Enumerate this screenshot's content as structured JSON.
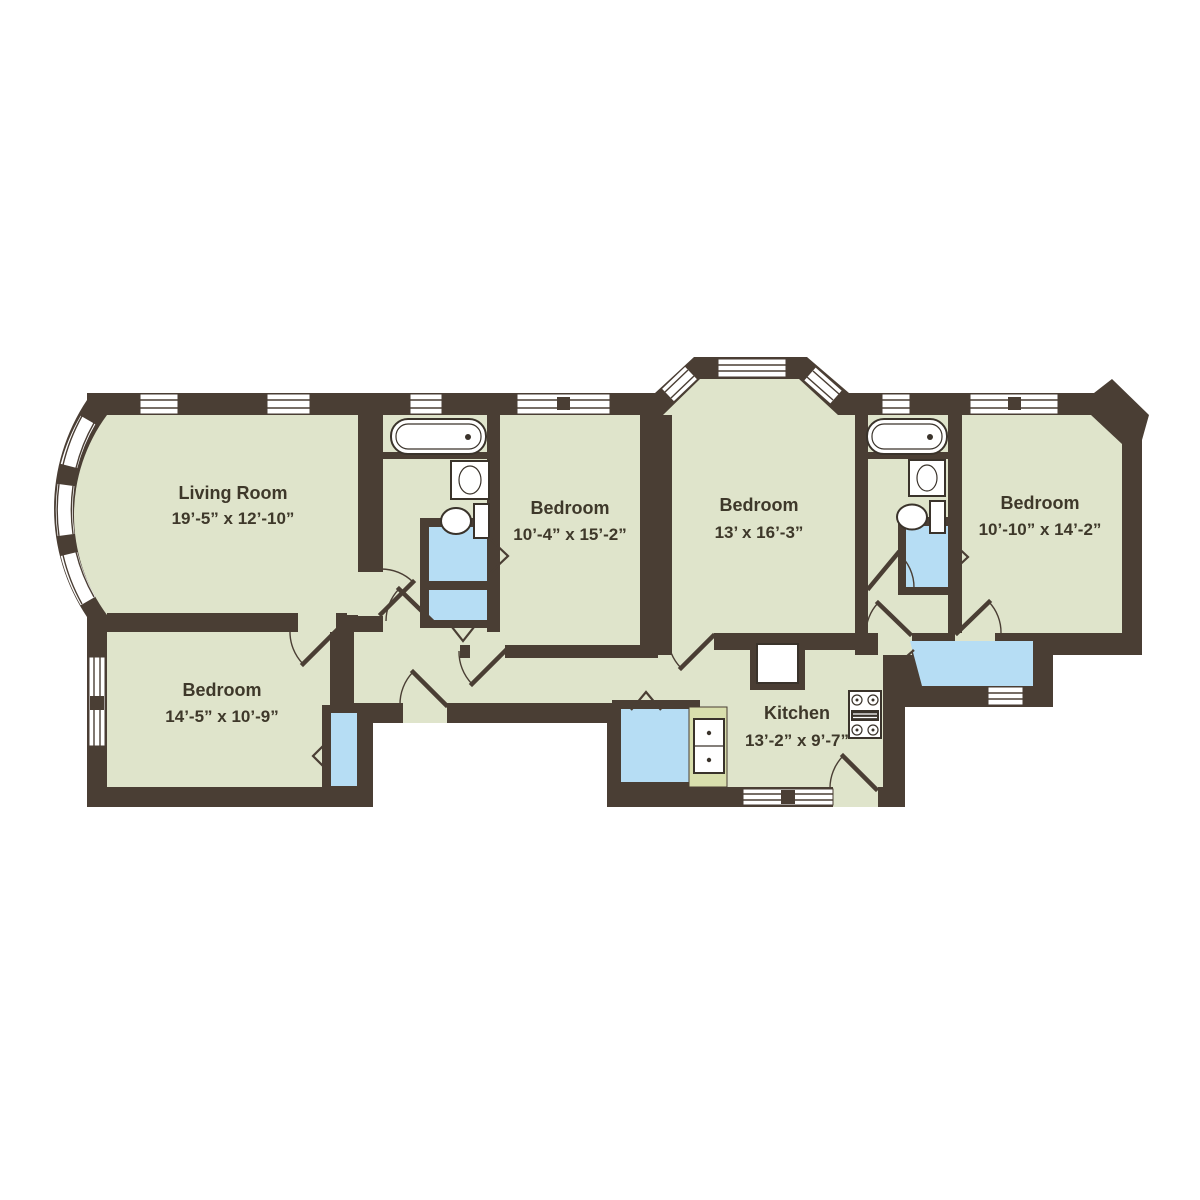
{
  "title": "Apartment floor plan",
  "colors": {
    "wall": "#4a3e34",
    "floor": "#dfe4cb",
    "closet_blue": "#b6ddf4",
    "counter_green": "#d9dfad",
    "fixture_outline": "#3a332b",
    "label_text": "#3e382a",
    "background": "#ffffff"
  },
  "rooms": {
    "living_room": {
      "name": "Living Room",
      "dimensions": "19’-5” x 12’-10”"
    },
    "bedroom_lower": {
      "name": "Bedroom",
      "dimensions": "14’-5” x 10’-9”"
    },
    "bedroom_second": {
      "name": "Bedroom",
      "dimensions": "10’-4” x 15’-2”"
    },
    "bedroom_middle": {
      "name": "Bedroom",
      "dimensions": "13’ x 16’-3”"
    },
    "bedroom_right": {
      "name": "Bedroom",
      "dimensions": "10’-10” x 14’-2”"
    },
    "kitchen": {
      "name": "Kitchen",
      "dimensions": "13’-2” x 9’-7”"
    }
  },
  "fixtures": [
    "bathtub",
    "toilet",
    "bathroom-sink",
    "kitchen-sink",
    "stove",
    "closet",
    "pantry",
    "bay-window",
    "window",
    "door-swing"
  ]
}
